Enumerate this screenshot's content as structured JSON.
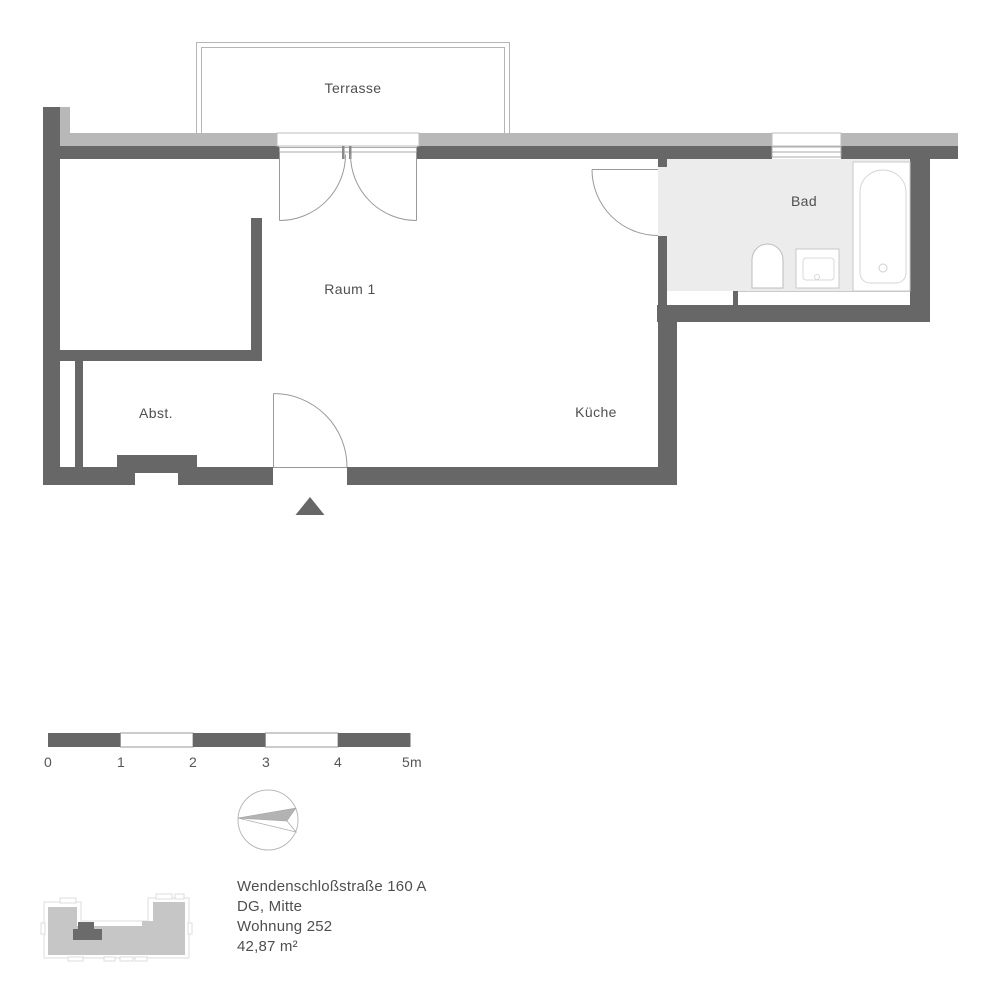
{
  "plan": {
    "rooms": {
      "terrasse": "Terrasse",
      "raum1": "Raum 1",
      "bad": "Bad",
      "abst": "Abst.",
      "kueche": "Küche"
    }
  },
  "scalebar": {
    "labels": [
      "0",
      "1",
      "2",
      "3",
      "4",
      "5m"
    ]
  },
  "info": {
    "address": "Wendenschloßstraße 160 A",
    "floor_location": "DG, Mitte",
    "unit": "Wohnung 252",
    "area": "42,87 m²"
  },
  "colors": {
    "wall": "#676767",
    "exterior_layer": "#b8b8b8",
    "bath_floor": "#ececec",
    "thin_outline": "#b5b5b5",
    "fixture_line": "#c9c9c9",
    "text": "#4f4f4f"
  }
}
